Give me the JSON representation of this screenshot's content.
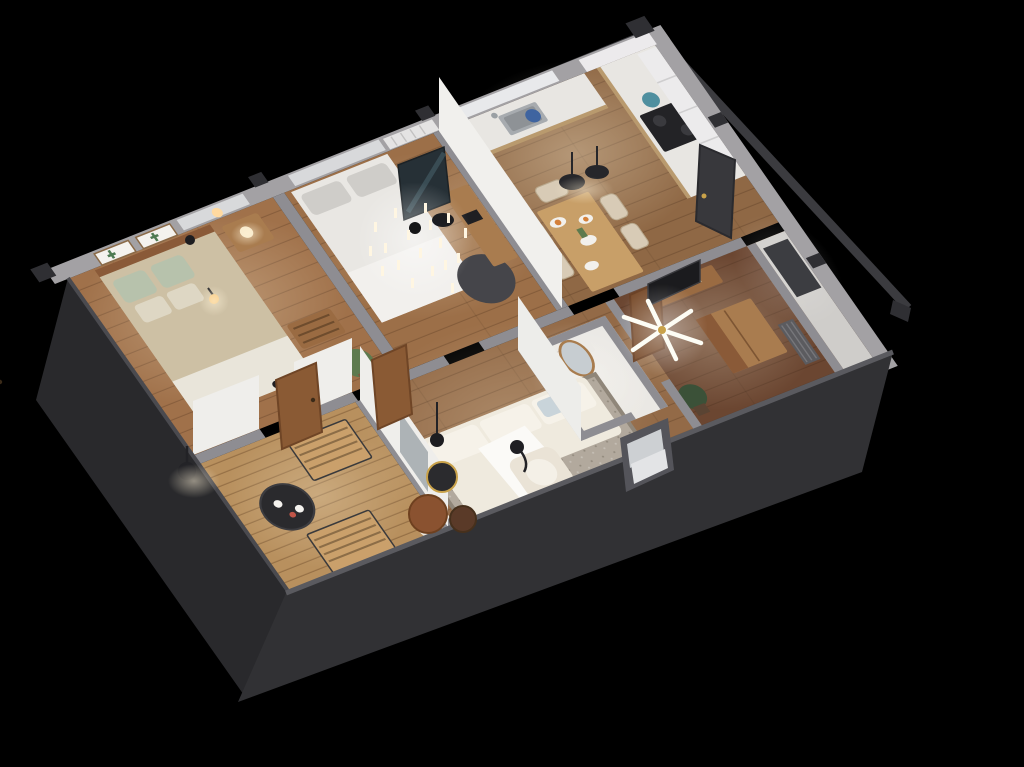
{
  "scene": {
    "type": "3d-isometric-floor-plan-render",
    "description": "Top-down 3D cutaway render of a furnished one-storey apartment on a black background, rotated diamond orientation, dark charcoal exterior walls facing the viewer, warm interior lighting",
    "background": "#000000"
  },
  "colors": {
    "bg": "#000000",
    "wall-top": "#8e8d92",
    "wall-top-ext": "#a3a1a4",
    "wall-dark-sw": "#29292c",
    "wall-dark-se": "#313134",
    "wall-edge": "#5a5a5f",
    "white-wall": "#efeeeb",
    "floor-br1": "#a0714a",
    "floor-br2": "#9c6f48",
    "floor-kitchen": "#8f6845",
    "floor-living": "#936a47",
    "floor-br3": "#6b4631",
    "floor-deck": "#b8905e",
    "floor-bath": "#eae8e4",
    "floor-entry": "#cfcdca",
    "rug": "#b2a99d",
    "rug-border": "#8f8679",
    "sofa": "#efeade",
    "cushion": "#f6f2e9",
    "throw": "#fbfaf7",
    "pillow-blue": "#c9d4da",
    "duvet": "#cdc0a4",
    "pillow-sage": "#b7c2ac",
    "linen": "#e9e5da",
    "bed-white": "#e9e7e3",
    "pillow-gray": "#cfcdc9",
    "wood": "#a97c4f",
    "wood-dark": "#8a5a38",
    "walnut": "#53301e",
    "wood-light": "#c89f68",
    "copper-table": "#8a5230",
    "chair-beige": "#d8cbb6",
    "plant": "#5d7a4e",
    "plant-dark": "#3b5138",
    "counter": "#e8e6e2",
    "steel": "#a7abaf",
    "cooktop": "#232326",
    "black": "#1f1f22",
    "glass": "#76838a",
    "mirror-glass": "#c7cdd1",
    "mirror-frame": "#a87c4e",
    "accent-teal": "#4f8f9f",
    "accent-blue": "#3f64a0",
    "accent-orange": "#d4803a",
    "accent-red": "#c05548",
    "lamp-warm": "#ffd9a0",
    "gold": "#c9a24a",
    "art-dark": "#263036",
    "mat": "#3c3d41",
    "radiator-dark": "#5b5b5f",
    "radiator-white": "#e4e3e3",
    "door-wood": "#8a5a34",
    "door-dark": "#38383c",
    "window-glass": "#d8d9db"
  },
  "rooms": [
    {
      "name": "master-bedroom",
      "furniture": [
        "double-bed",
        "wood-headboard",
        "sage-pillows",
        "nightstand",
        "table-lamp",
        "storage-bench",
        "potted-plant",
        "cactus-framed-art-pair",
        "window-shade",
        "pendant-wall-lamp",
        "ceiling-light"
      ]
    },
    {
      "name": "second-bedroom",
      "furniture": [
        "white-bed",
        "gray-pillows",
        "candle-chandelier",
        "dark-leaning-artwork",
        "wood-desk",
        "laptop",
        "round-dark-table",
        "wall-radiator",
        "window-shade"
      ]
    },
    {
      "name": "kitchen-dining",
      "furniture": [
        "l-shaped-counter",
        "sink",
        "faucet",
        "cooktop",
        "teal-pot",
        "blue-pot",
        "upper-cabinets",
        "range-window-shade",
        "dining-table",
        "beige-chairs",
        "plates-with-food",
        "flower-vase",
        "black-pendant-lamps"
      ]
    },
    {
      "name": "living-room",
      "furniture": [
        "white-sofa",
        "chaise",
        "throw-blanket",
        "blue-pillow",
        "area-rug",
        "wire-side-table",
        "copper-coffee-table",
        "round-side-table",
        "console-table",
        "potted-plant",
        "armchair",
        "floor-pouf",
        "black-pendant-lamp",
        "sphere-floor-lamp",
        "two-wood-doors"
      ]
    },
    {
      "name": "bathroom",
      "furniture": [
        "oval-mirror",
        "vanity",
        "basin",
        "shower-glass-panel"
      ]
    },
    {
      "name": "third-bedroom",
      "furniture": [
        "wall-tv",
        "wood-sideboard",
        "white-vase",
        "sputnik-ceiling-lamp",
        "wardrobe",
        "dark-radiator",
        "tall-plant",
        "wood-door"
      ]
    },
    {
      "name": "balcony",
      "furniture": [
        "slatted-lounge-chair",
        "slatted-folding-chair",
        "black-bistro-table",
        "coffee-cups",
        "red-flower",
        "black-wall-sconce",
        "wood-decking"
      ]
    },
    {
      "name": "entry-hall",
      "furniture": [
        "dark-entry-door",
        "dark-floor-mat",
        "pale-floor"
      ]
    }
  ],
  "building": {
    "storeys": 1,
    "view": "cutaway top-down isometric",
    "exterior-features": [
      "charcoal-facade",
      "small-facade-window",
      "corner-wall-caps"
    ]
  }
}
